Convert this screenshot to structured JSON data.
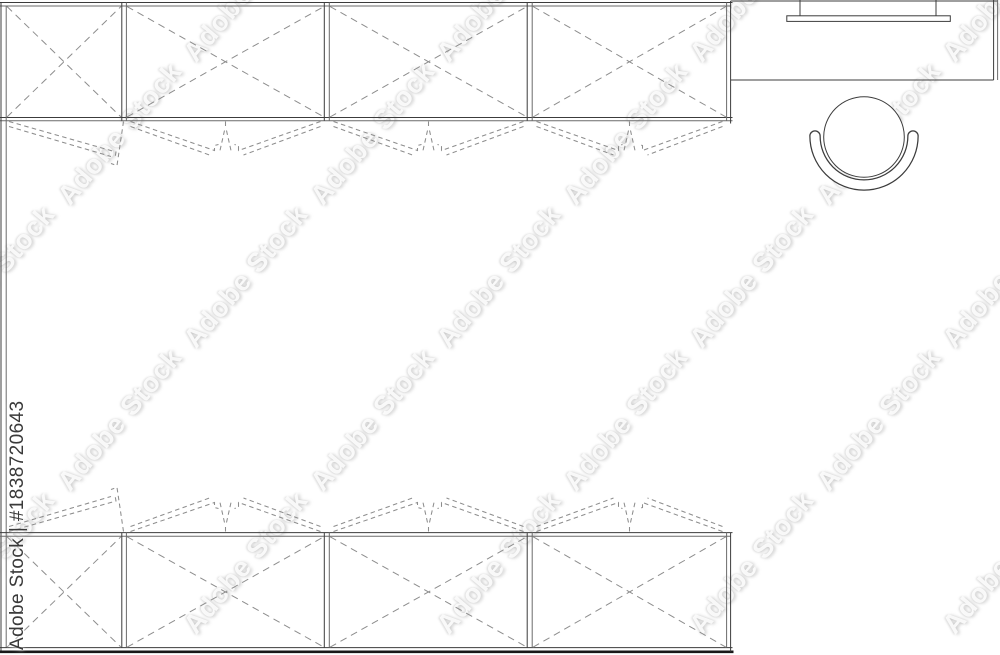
{
  "watermark": {
    "label": "Adobe Stock | #1838720643",
    "ghost_text": "Adobe Stock",
    "ghost_color": "rgba(252,252,252,0.92)"
  },
  "palette": {
    "background": "#ffffff",
    "line_dark": "#3c3c3c",
    "line_light": "#6b6b6b",
    "dash_gray": "#8d8d8d",
    "edge_black": "#181818",
    "label_gray": "#3a3a3a"
  },
  "plan": {
    "top_cabinet_row_units": 4,
    "bottom_cabinet_row_units": 4,
    "objects": [
      "wardrobe-row-top",
      "wardrobe-row-bottom",
      "left-wall",
      "desk",
      "monitor",
      "office-chair"
    ]
  }
}
